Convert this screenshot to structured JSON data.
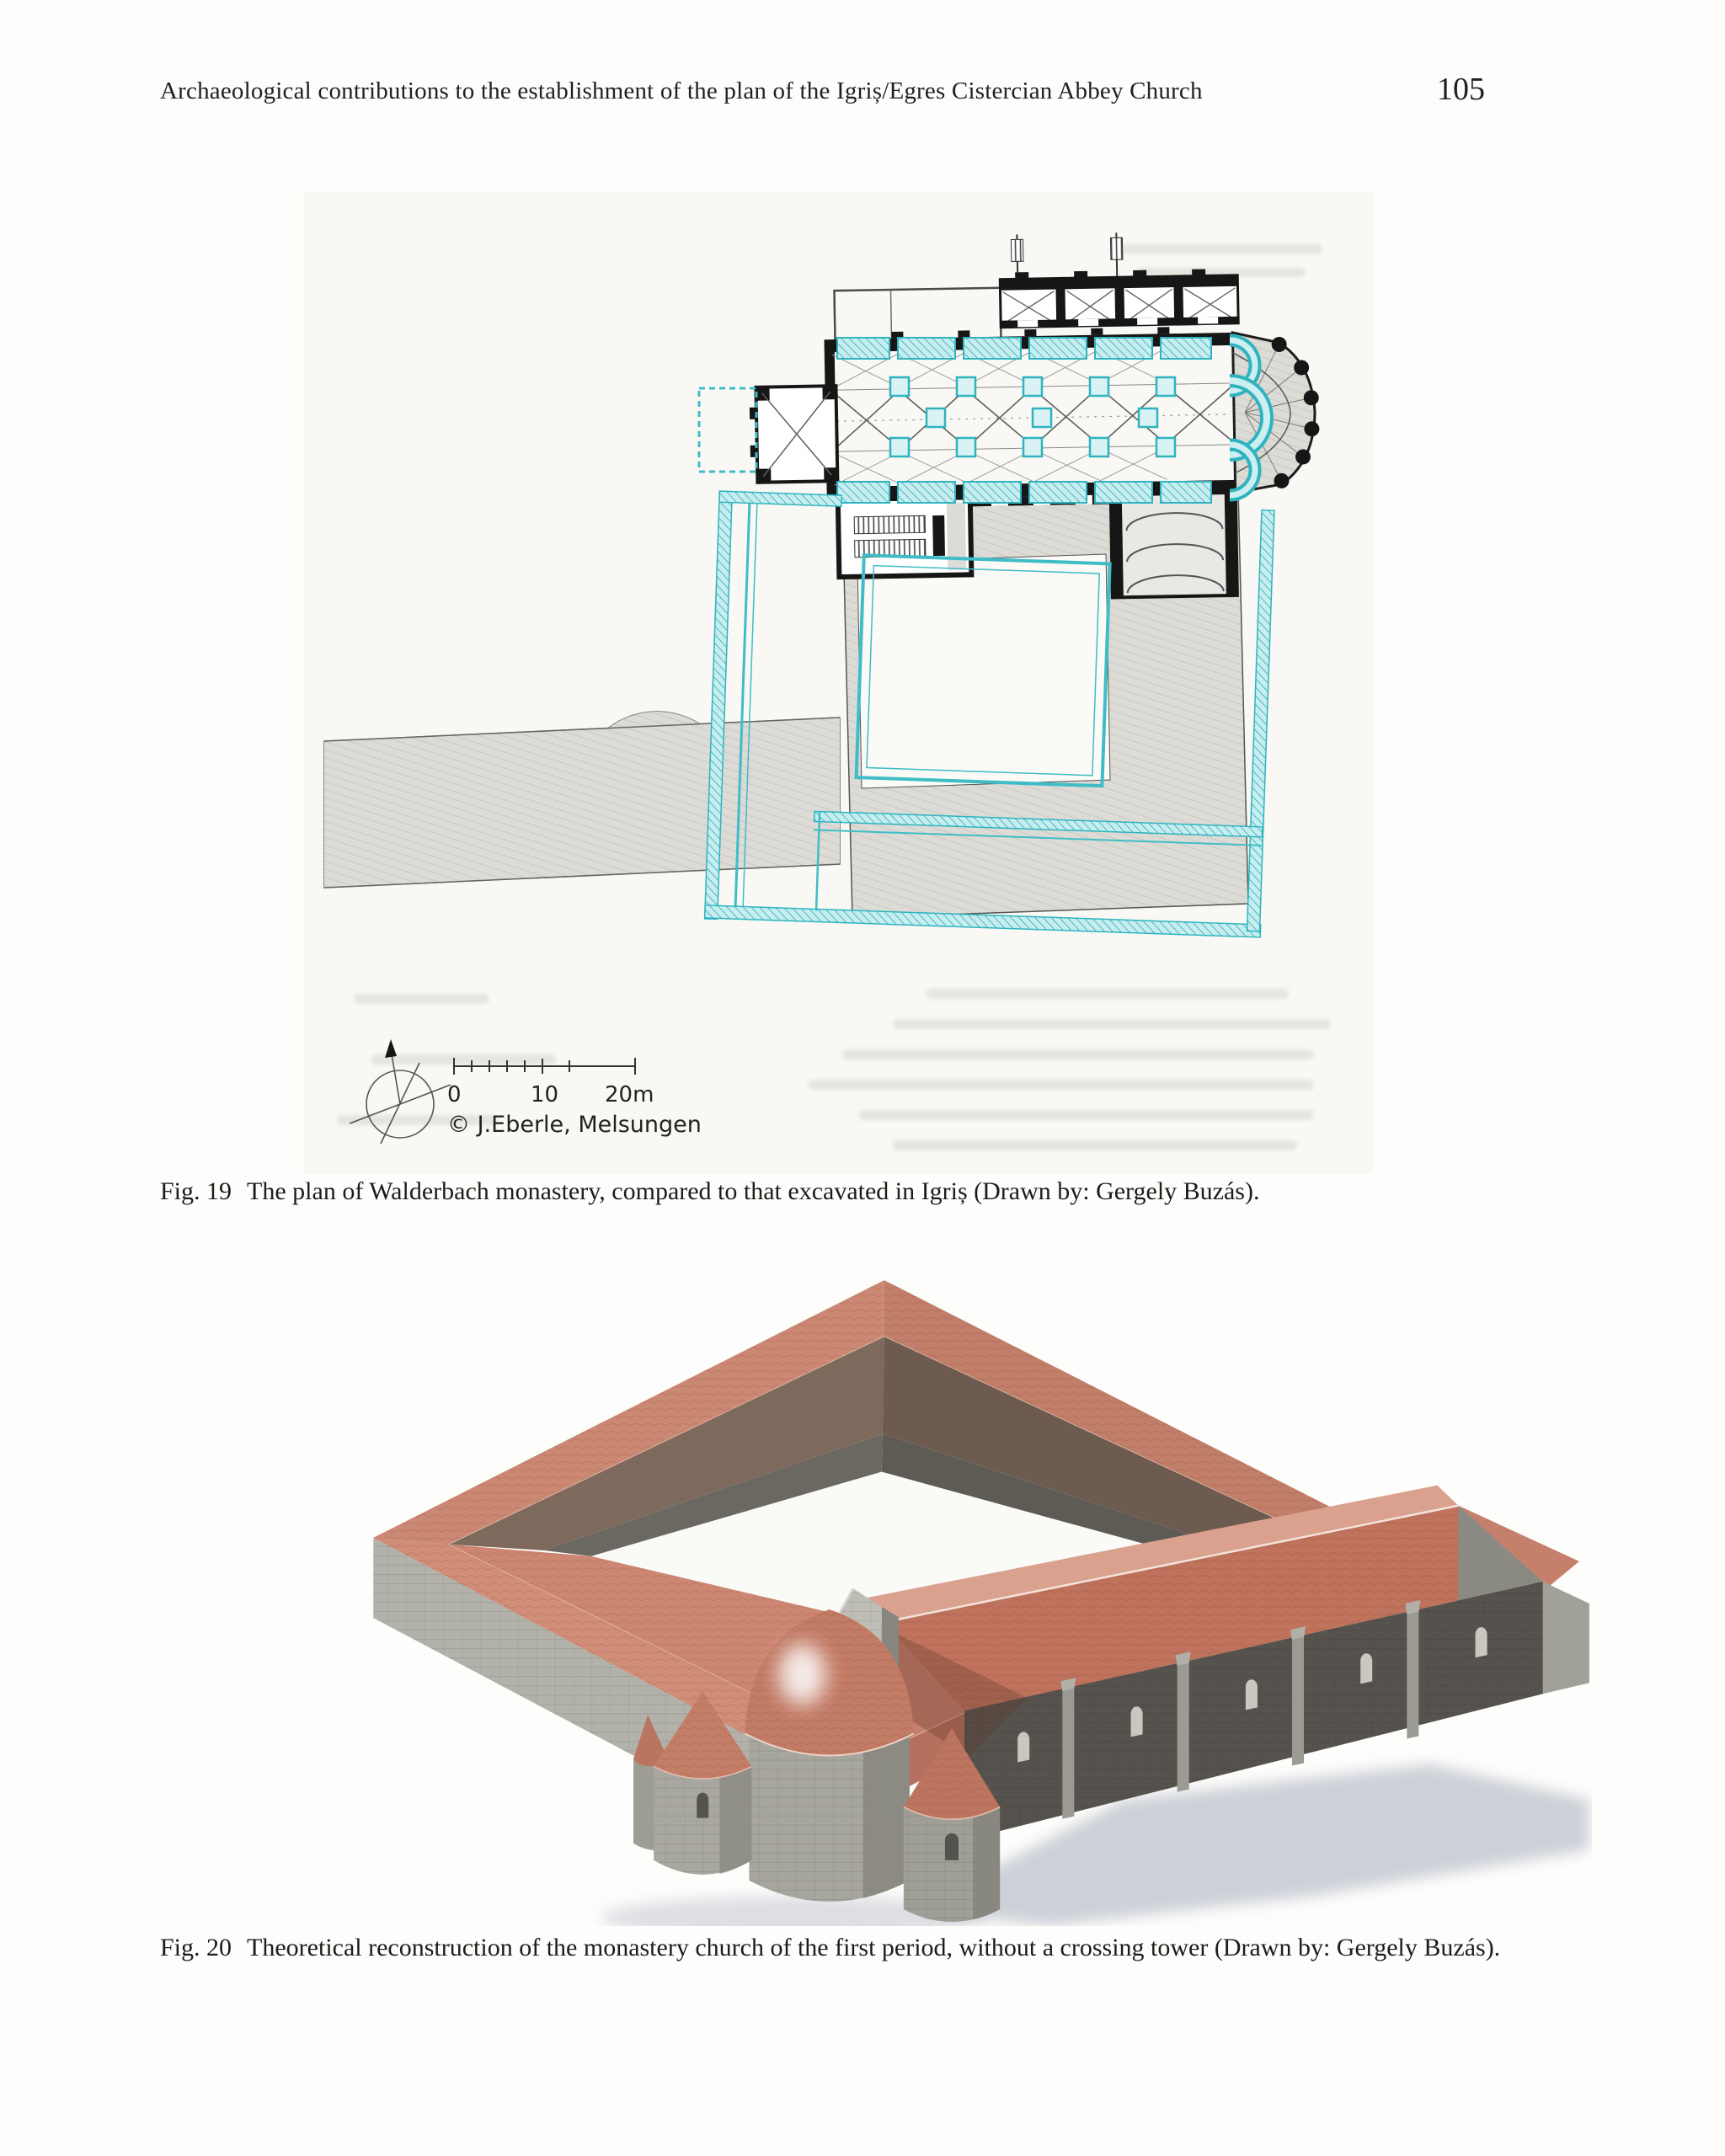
{
  "page": {
    "header": {
      "title": "Archaeological contributions to the establishment of the plan of the Igriș/Egres Cistercian Abbey Church",
      "page_number": "105"
    },
    "figure19": {
      "label": "Fig. 19",
      "caption": "The plan of Walderbach monastery, compared to that excavated in Igriș (Drawn by: Gergely Buzás).",
      "scale_bar": {
        "tick_0": "0",
        "tick_10": "10",
        "tick_20": "20m"
      },
      "credit": "© J.Eberle, Melsungen",
      "colors": {
        "walderbach_plan": "#161616",
        "igris_overlay": "#3fbdc7",
        "shading_gray": "#dcdbd6"
      }
    },
    "figure20": {
      "label": "Fig. 20",
      "caption": "Theoretical reconstruction of the monastery church of the first period, without a crossing tower (Drawn by: Gergely Buzás).",
      "colors": {
        "roof": "#c5826d",
        "wall": "#b2b1aa",
        "shadow": "#aeb3c0"
      }
    }
  }
}
